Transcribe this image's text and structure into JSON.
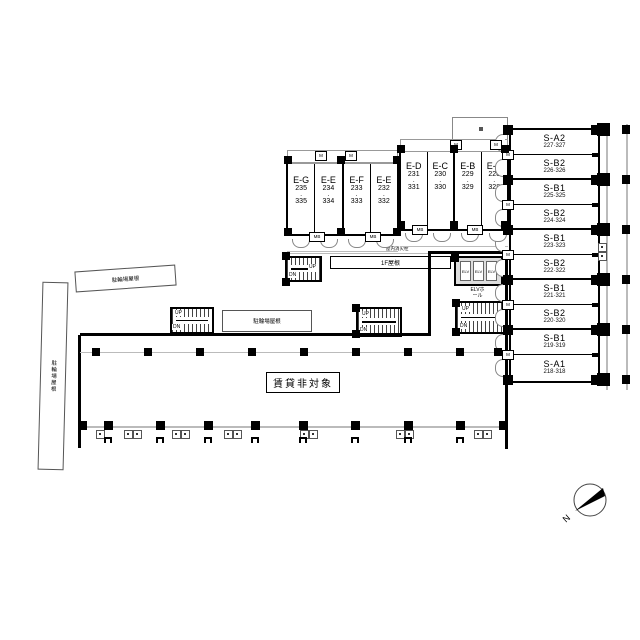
{
  "plan": {
    "s_tower": {
      "units": [
        {
          "name": "S-A2",
          "rooms": "227·327"
        },
        {
          "name": "S-B2",
          "rooms": "226·326"
        },
        {
          "name": "S-B1",
          "rooms": "225·325"
        },
        {
          "name": "S-B2",
          "rooms": "224·324"
        },
        {
          "name": "S-B1",
          "rooms": "223·323"
        },
        {
          "name": "S-B2",
          "rooms": "222·322"
        },
        {
          "name": "S-B1",
          "rooms": "221·321"
        },
        {
          "name": "S-B2",
          "rooms": "220·320"
        },
        {
          "name": "S-B1",
          "rooms": "219·319"
        },
        {
          "name": "S-A1",
          "rooms": "218·318"
        }
      ]
    },
    "e_building": {
      "units_left": [
        {
          "name": "E-G",
          "upper": "235",
          "lower": "335"
        },
        {
          "name": "E-E",
          "upper": "234",
          "lower": "334"
        },
        {
          "name": "E-F",
          "upper": "233",
          "lower": "333"
        },
        {
          "name": "E-E",
          "upper": "232",
          "lower": "332"
        }
      ],
      "units_right": [
        {
          "name": "E-D",
          "upper": "231",
          "lower": "331"
        },
        {
          "name": "E-C",
          "upper": "230",
          "lower": "330"
        },
        {
          "name": "E-B",
          "upper": "229",
          "lower": "329"
        },
        {
          "name": "E-A",
          "upper": "228",
          "lower": "328"
        }
      ]
    },
    "labels": {
      "not_for_lease": "賃貸非対象",
      "bike_shed_roof": "駐輪場屋根",
      "roof_1f": "1F屋根",
      "elv": "ELV",
      "elv_hall": "ELVホール",
      "up": "UP",
      "dn": "DN",
      "meter_box": "MB",
      "meter": "M",
      "indoor_hydrant": "屋内消火栓",
      "north": "N",
      "dot": "・"
    }
  }
}
